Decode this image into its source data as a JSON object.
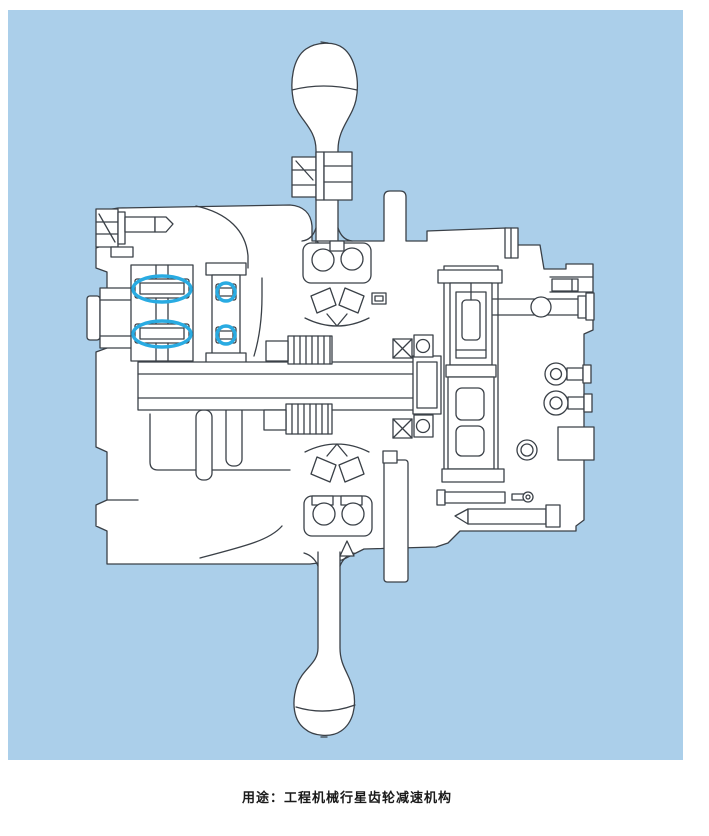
{
  "figure": {
    "colors": {
      "panel": "#abcfea",
      "line": "#3a4047",
      "highlight": "#29abe2",
      "caption": "#1a1a1a"
    },
    "description": "Cross-section engineering drawing of a planetary gear reduction final drive",
    "highlight_marks": [
      "main-roller-bearing-upper",
      "main-roller-bearing-lower",
      "planet-shaft-bearing-upper",
      "planet-shaft-bearing-lower"
    ]
  },
  "caption": {
    "text": "用途：工程机械行星齿轮减速机构"
  }
}
